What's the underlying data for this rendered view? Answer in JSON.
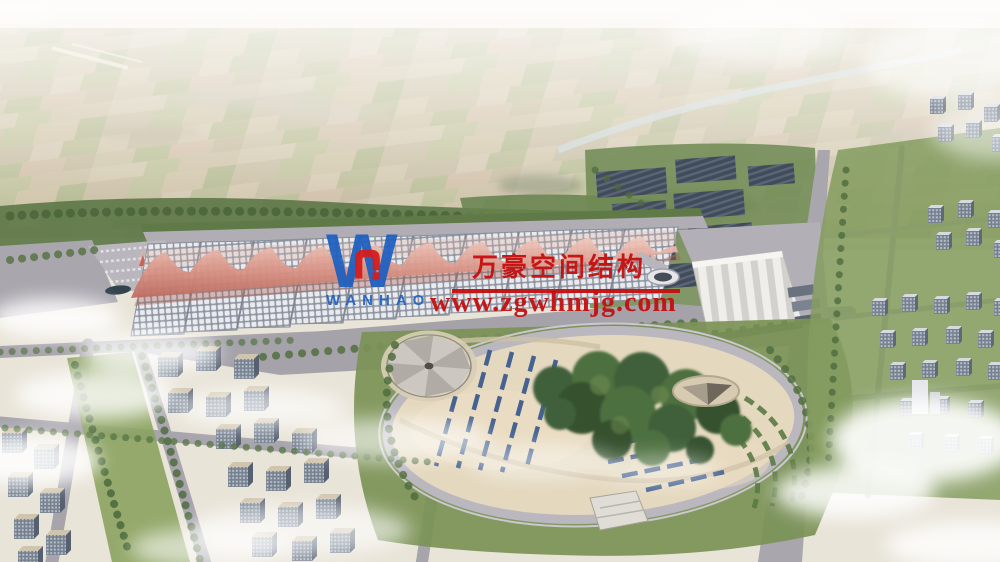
{
  "scene": {
    "kind": "aerial architectural rendering",
    "subject": "exhibition center complex with membrane-roof halls, central park, solar arrays and surrounding city blocks",
    "colors": {
      "haze_sky": "#f1ede4",
      "farmland": "#c6ba9c",
      "trees": "#55703f",
      "roads": "#a6a3ab",
      "hall_roof_cells": "#e9ebef",
      "membrane_pink": "#cf8579",
      "solar_panels": "#46505e",
      "park_ground": "#e2d6bc",
      "panel_blue": "#3b5a8c",
      "cloud": "#ffffff"
    }
  },
  "watermark": {
    "logo_letter": "W",
    "logo_text": "WANHAO",
    "company_name_cn": "万豪空间结构",
    "website_url": "www.zgwhmjg.com",
    "text_color": "#c40f0f",
    "logo_blue": "#1e5fc0",
    "logo_red": "#d41d1d"
  }
}
